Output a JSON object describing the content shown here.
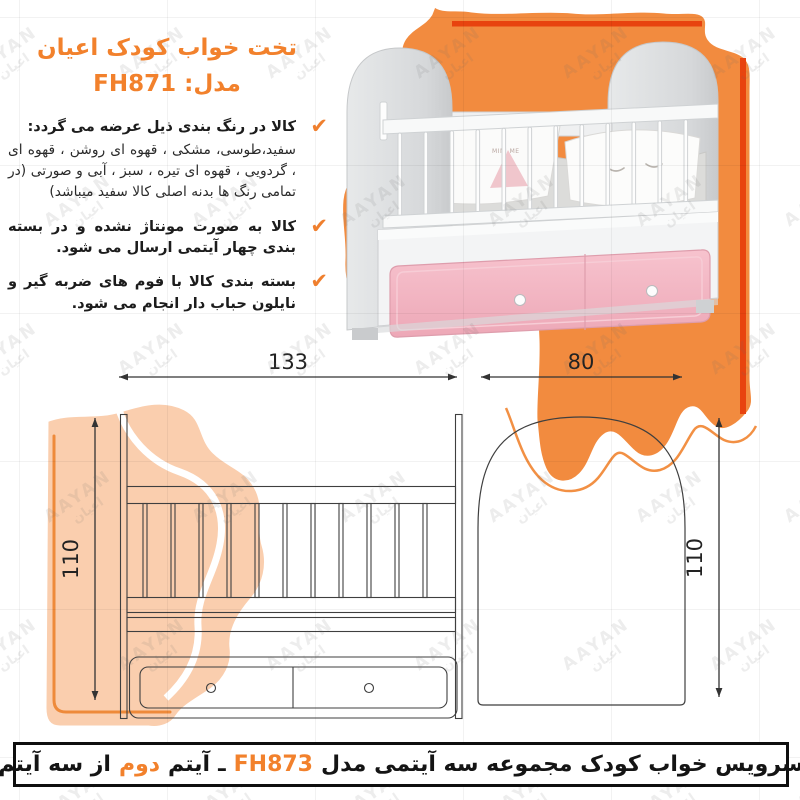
{
  "title": {
    "line1": "تخت خواب کودک اعیان",
    "model_label": "مدل:",
    "model": "FH871"
  },
  "bullets": [
    {
      "heading": "کالا در رنگ بندی ذیل عرضه می گردد:",
      "body": "سفید،طوسی، مشکی ، قهوه ای روشن ، قهوه ای ، گردویی ، قهوه ای تیره ، سبز ، آبی و صورتی (در تمامی رنگ ها بدنه اصلی کالا سفید میباشد)"
    },
    {
      "heading": "کالا به صورت مونتاژ نشده و در بسته بندی چهار آیتمی ارسال می شود.",
      "body": ""
    },
    {
      "heading": "بسته بندی کالا با فوم های ضربه گیر و نایلون حباب دار انجام می شود.",
      "body": ""
    }
  ],
  "checkmark_glyph": "✔",
  "dimensions": {
    "front_width": "133",
    "side_width": "80",
    "front_height": "110",
    "side_height": "110"
  },
  "hero": {
    "pillow_print": "MINI ME"
  },
  "watermark": {
    "latin": "AAYAN",
    "fa": "اعیان"
  },
  "footer": {
    "text_main": "سرویس خواب کودک مجموعه سه آیتمی مدل",
    "model": "FH873",
    "separator": "ـ",
    "item_label": "آیتم",
    "item_number": "دوم",
    "item_rest": "از سه آیتم"
  },
  "colors": {
    "accent_orange": "#F2812C",
    "blob_orange": "#F28B3F",
    "stripe_red": "#E8430F",
    "peach_blob": "#F6C9A0",
    "drawer_pink": "#F2B3C0"
  }
}
